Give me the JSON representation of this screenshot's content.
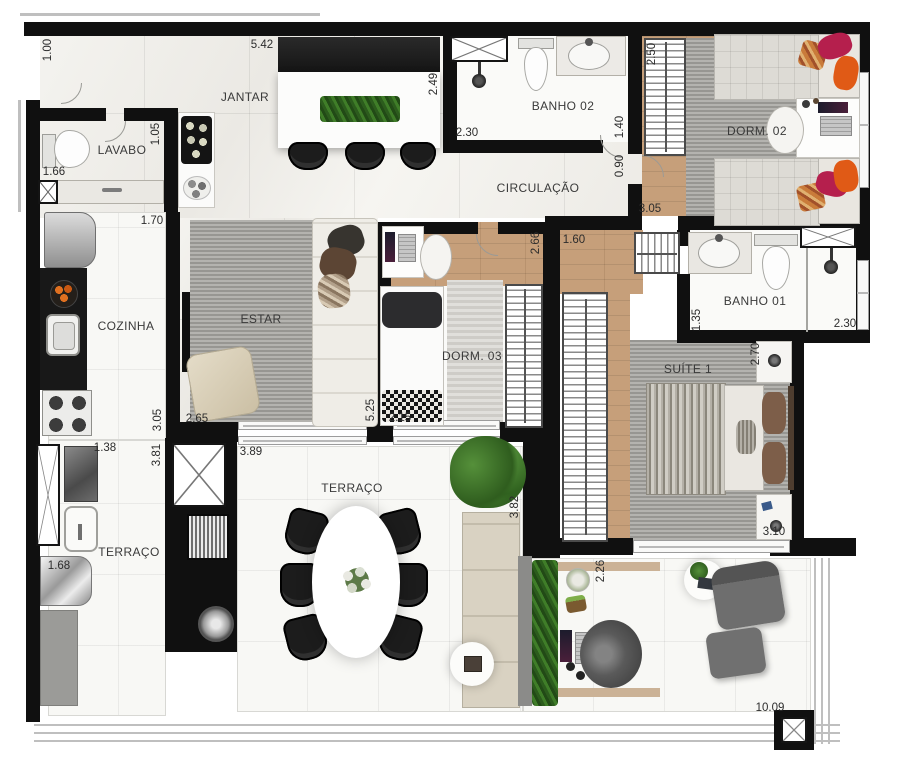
{
  "rooms": {
    "jantar": "JANTAR",
    "lavabo": "LAVABO",
    "banho02": "BANHO 02",
    "dorm02": "DORM. 02",
    "circulacao": "CIRCULAÇÃO",
    "cozinha": "COZINHA",
    "estar": "ESTAR",
    "dorm03": "DORM. 03",
    "banho01": "BANHO 01",
    "suite1": "SUÍTE 1",
    "terraco_servico": "TERRAÇO",
    "terraco": "TERRAÇO"
  },
  "measurements": {
    "entry_height": "1.00",
    "jantar_width": "5.42",
    "jantar_depth": "2.49",
    "banho02_shower": "2.30",
    "banho02_width": "1.40",
    "dorm02_closet": "2.50",
    "dorm02_door": "0.90",
    "circulacao_width": "3.05",
    "lavabo_width": "1.05",
    "lavabo_height": "1.66",
    "cozinha_pass": "1.70",
    "cozinha_height": "3.05",
    "servico_width": "1.38",
    "servico_height": "3.81",
    "estar_width": "2.65",
    "estar_height": "5.25",
    "dorm03_bed": "2.15",
    "dorm03_height": "2.66",
    "suite_hall": "1.60",
    "banho01_height": "1.35",
    "banho01_width": "2.30",
    "suite_height": "2.70",
    "suite_width": "3.10",
    "terraco_width": "3.89",
    "terraco_height": "3.82",
    "washer_width": "1.68",
    "lounge_height": "2.26",
    "total_width": "10.09"
  },
  "colors": {
    "wall": "#101010",
    "wood": "#c69f7a",
    "rug": "#a8a7a2",
    "green": "#3c7028",
    "accent-pink": "#b51f4d",
    "accent-orange": "#e05a16",
    "bench": "#d9d2c2"
  }
}
